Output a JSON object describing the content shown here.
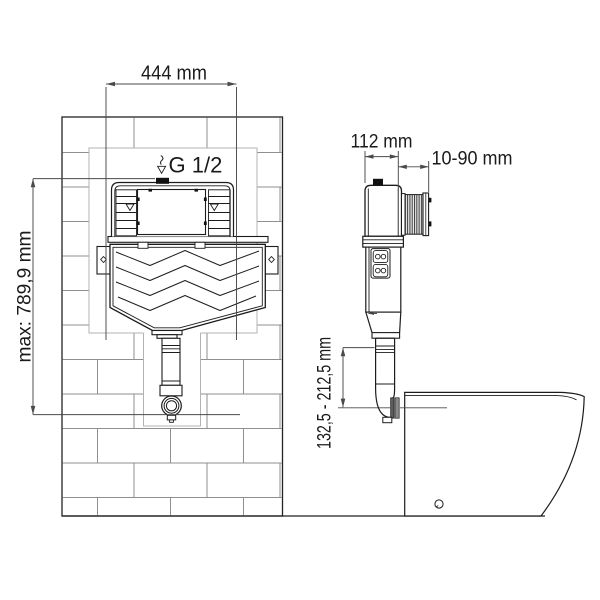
{
  "drawing": {
    "front_view": {
      "width_dim": "444 mm",
      "height_dim": "max: 789,9 mm",
      "inlet_label": "G 1/2"
    },
    "side_view": {
      "depth_dim": "112 mm",
      "adjust_dim": "10-90 mm",
      "outlet_height_dim": "132,5 - 212,5 mm"
    }
  },
  "icons": {
    "water_inlet_icon": "water-drop"
  },
  "colors": {
    "outline": "#1c1c1c",
    "dim_line": "#4a4a4a",
    "brick_line": "#8f8f8f",
    "niche_line": "#b3b3b3",
    "text": "#1a1a1a",
    "background": "#ffffff"
  }
}
